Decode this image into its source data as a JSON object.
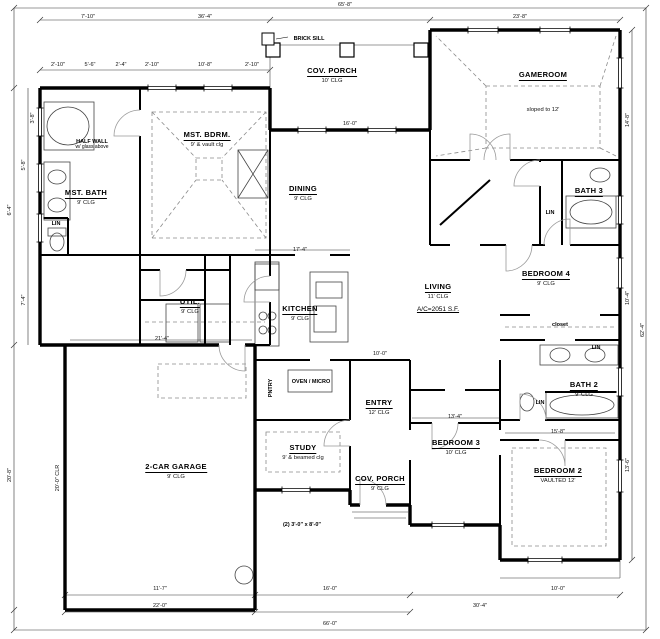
{
  "drawing": {
    "colors": {
      "wall": "#000000",
      "thin": "#555555",
      "dashed": "#8a8a8a",
      "dim": "#333333"
    },
    "rooms": [
      {
        "id": "cov-porch-top",
        "label": "COV. PORCH",
        "sub": "10' CLG",
        "x": 332,
        "y": 60
      },
      {
        "id": "gameroom",
        "label": "GAMEROOM",
        "sub": "sloped to 12'",
        "sub_dy": 34,
        "x": 543,
        "y": 64
      },
      {
        "id": "mst-bdrm",
        "label": "MST. BDRM.",
        "sub": "9' & vault clg",
        "x": 207,
        "y": 124
      },
      {
        "id": "dining",
        "label": "DINING",
        "sub": "9' CLG",
        "x": 303,
        "y": 178
      },
      {
        "id": "mst-bath",
        "label": "MST. BATH",
        "sub": "9' CLG",
        "x": 86,
        "y": 182
      },
      {
        "id": "bath-3",
        "label": "BATH 3",
        "sub": "",
        "x": 589,
        "y": 180
      },
      {
        "id": "bedroom-4",
        "label": "BEDROOM 4",
        "sub": "9' CLG",
        "x": 546,
        "y": 263
      },
      {
        "id": "living",
        "label": "LIVING",
        "sub": "11' CLG",
        "extra": "A/C=2051 S.F.",
        "x": 438,
        "y": 276
      },
      {
        "id": "kitchen",
        "label": "KITCHEN",
        "sub": "9' CLG",
        "x": 300,
        "y": 298
      },
      {
        "id": "util",
        "label": "UTIL.",
        "sub": "9' CLG",
        "x": 190,
        "y": 291
      },
      {
        "id": "bath-2",
        "label": "BATH 2",
        "sub": "9' CLG",
        "x": 584,
        "y": 374
      },
      {
        "id": "bedroom-3",
        "label": "BEDROOM 3",
        "sub": "10' CLG",
        "x": 456,
        "y": 432
      },
      {
        "id": "bedroom-2",
        "label": "BEDROOM 2",
        "sub": "VAULTED 12'",
        "x": 558,
        "y": 460
      },
      {
        "id": "study",
        "label": "STUDY",
        "sub": "9' & beamed clg",
        "x": 303,
        "y": 437
      },
      {
        "id": "entry",
        "label": "ENTRY",
        "sub": "12' CLG",
        "x": 379,
        "y": 392
      },
      {
        "id": "cov-porch-bottom",
        "label": "COV. PORCH",
        "sub": "9' CLG",
        "x": 380,
        "y": 468
      },
      {
        "id": "garage",
        "label": "2-CAR GARAGE",
        "sub": "9' CLG",
        "x": 176,
        "y": 456
      }
    ],
    "notes": [
      {
        "id": "brick-sill",
        "text": "BRICK SILL",
        "x": 309,
        "y": 36
      },
      {
        "id": "half-wall",
        "text": "HALF WALL",
        "sub": "w/ glass above",
        "x": 92,
        "y": 139
      },
      {
        "id": "lin-master",
        "text": "LIN",
        "x": 56,
        "y": 221
      },
      {
        "id": "lin-bath3",
        "text": "LIN",
        "x": 550,
        "y": 210
      },
      {
        "id": "lin-bath2-a",
        "text": "LIN",
        "x": 596,
        "y": 345
      },
      {
        "id": "lin-bath2-b",
        "text": "LIN",
        "x": 540,
        "y": 400
      },
      {
        "id": "closet-bed4",
        "text": "closet",
        "x": 560,
        "y": 322
      },
      {
        "id": "pantry",
        "text": "PNTRY",
        "x": 271,
        "y": 388,
        "vertical": true
      },
      {
        "id": "oven-micro",
        "text": "OVEN / MICRO",
        "x": 311,
        "y": 379
      },
      {
        "id": "door-note",
        "text": "(2) 3'-0\" x 8'-0\"",
        "x": 302,
        "y": 522
      }
    ],
    "dimensions": [
      {
        "text": "65'-8\"",
        "x": 345,
        "y": 2
      },
      {
        "text": "7'-10\"",
        "x": 88,
        "y": 14
      },
      {
        "text": "36'-4\"",
        "x": 205,
        "y": 14
      },
      {
        "text": "23'-8\"",
        "x": 520,
        "y": 14
      },
      {
        "text": "2'-10\"",
        "x": 58,
        "y": 62
      },
      {
        "text": "5'-6\"",
        "x": 90,
        "y": 62
      },
      {
        "text": "2'-4\"",
        "x": 121,
        "y": 62
      },
      {
        "text": "2'-10\"",
        "x": 152,
        "y": 62
      },
      {
        "text": "10'-8\"",
        "x": 205,
        "y": 62
      },
      {
        "text": "2'-10\"",
        "x": 252,
        "y": 62
      },
      {
        "text": "16'-0\"",
        "x": 350,
        "y": 121
      },
      {
        "text": "17'-4\"",
        "x": 300,
        "y": 247
      },
      {
        "text": "10'-0\"",
        "x": 380,
        "y": 351
      },
      {
        "text": "13'-4\"",
        "x": 455,
        "y": 414
      },
      {
        "text": "15'-8\"",
        "x": 558,
        "y": 429
      },
      {
        "text": "21'-4\"",
        "x": 162,
        "y": 336
      },
      {
        "text": "6'-4\"",
        "x": 10,
        "y": 210,
        "rot": -90
      },
      {
        "text": "20'-8\"",
        "x": 10,
        "y": 475,
        "rot": -90
      },
      {
        "text": "5'-8\"",
        "x": 24,
        "y": 165,
        "rot": -90
      },
      {
        "text": "7'-4\"",
        "x": 24,
        "y": 300,
        "rot": -90
      },
      {
        "text": "3'-8\"",
        "x": 33,
        "y": 118,
        "rot": -90
      },
      {
        "text": "20'-0\" CLR",
        "x": 58,
        "y": 478,
        "rot": -90
      },
      {
        "text": "14'-8\"",
        "x": 628,
        "y": 120,
        "rot": -90
      },
      {
        "text": "10'-4\"",
        "x": 628,
        "y": 298,
        "rot": -90
      },
      {
        "text": "13'-6\"",
        "x": 628,
        "y": 465,
        "rot": -90
      },
      {
        "text": "62'-4\"",
        "x": 643,
        "y": 330,
        "rot": -90
      },
      {
        "text": "11'-7\"",
        "x": 160,
        "y": 586
      },
      {
        "text": "16'-0\"",
        "x": 330,
        "y": 586
      },
      {
        "text": "10'-0\"",
        "x": 558,
        "y": 586
      },
      {
        "text": "22'-0\"",
        "x": 160,
        "y": 603
      },
      {
        "text": "30'-4\"",
        "x": 480,
        "y": 603
      },
      {
        "text": "66'-0\"",
        "x": 330,
        "y": 621
      }
    ]
  }
}
